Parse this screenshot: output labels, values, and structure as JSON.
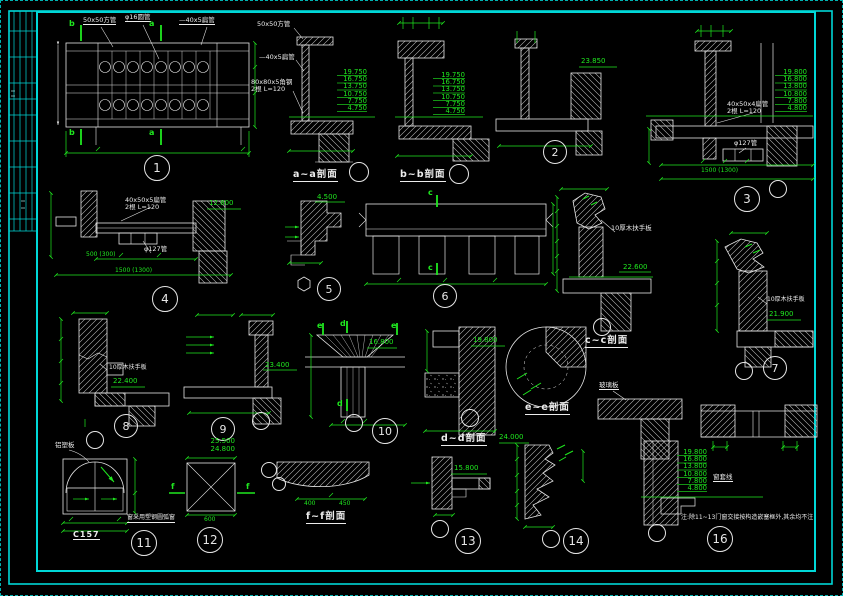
{
  "colors": {
    "bg": "#000000",
    "line": "#e6e6e6",
    "dim_green": "#1fe81f",
    "frame_cyan": "#00d8d8"
  },
  "d1": {
    "num": "1",
    "lbl_sq": "50x50方管",
    "lbl_pipe": "φ16圆管",
    "lbl_flat": "—40x5扁管",
    "mk_a": "a",
    "mk_b": "b"
  },
  "sa": {
    "cap": "a~a剖面",
    "l1": "50x50方管",
    "l2": "—40x5扁管",
    "l3": "80x80x5角钢\n2根 L=120",
    "elev": "19.750\n16.750\n13.750\n10.750\n7.750\n4.750"
  },
  "sb": {
    "cap": "b~b剖面",
    "elev": "19.750\n16.750\n13.750\n10.750\n7.750\n4.750"
  },
  "d2": {
    "num": "2",
    "elev": "23.850"
  },
  "d3": {
    "num": "3",
    "l1": "40x50x4扁管\n2根 L=120",
    "l2": "φ127管",
    "elev": "19.800\n16.800\n13.800\n10.800\n7.800\n4.800",
    "dim": "1500 (1300)"
  },
  "d4": {
    "num": "4",
    "l1": "40x50x5扁管\n2根 L=120",
    "l2": "φ127管",
    "elev": "12.800",
    "dim1": "500 (300)",
    "dim2": "1500 (1300)"
  },
  "d5": {
    "num": "5",
    "elev": "4.500"
  },
  "d6": {
    "num": "6",
    "mk": "c"
  },
  "sc": {
    "cap": "c~c剖面",
    "lbl": "10厚木扶手板",
    "elev": "22.600"
  },
  "d7": {
    "num": "7",
    "lbl": "10厚木扶手板",
    "elev": "21.900"
  },
  "d8": {
    "num": "8",
    "lbl": "10厚木扶手板",
    "elev": "22.400"
  },
  "d9": {
    "num": "9",
    "elev": "23.400"
  },
  "d10": {
    "num": "10",
    "elev": "16.800",
    "mk_e": "e",
    "mk_d": "d"
  },
  "sd": {
    "cap": "d~d剖面",
    "elev": "19.800"
  },
  "se": {
    "cap": "e~e剖面"
  },
  "d11": {
    "num": "11",
    "lbl": "铝塑板",
    "code": "C157",
    "note": "窗采用塑钢圆弧窗"
  },
  "d12": {
    "num": "12",
    "elev": "25.500\n24.800",
    "mk": "f",
    "dim": "600"
  },
  "sf": {
    "cap": "f~f剖面",
    "dim1": "400",
    "dim2": "450"
  },
  "d13": {
    "num": "13",
    "elev": "15.800"
  },
  "d14": {
    "num": "14",
    "elev": "24.000"
  },
  "d16": {
    "num": "16",
    "lbl_glass": "玻璃板",
    "lbl_case": "窗套线",
    "elev": "19.800\n16.800\n13.800\n10.800\n7.800\n4.800",
    "note": "注:除11~13门窗交接按构造嵌塞框外,其余均不注"
  }
}
